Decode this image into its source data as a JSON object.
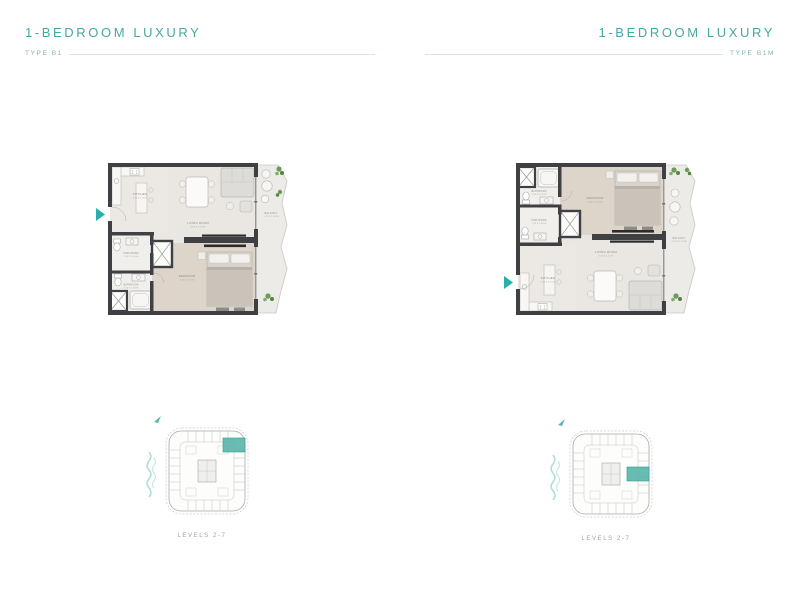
{
  "colors": {
    "accent_teal": "#47a7a3",
    "type_label_teal": "#7cb6b3",
    "entry_arrow_teal": "#27b0ab",
    "unit_highlight_teal": "#54b3a7",
    "wall_charcoal": "#3f4043",
    "water_wave_teal": "#b2dedb"
  },
  "panels": [
    {
      "title": "1-BEDROOM LUXURY",
      "type_label": "TYPE B1",
      "levels_label": "LEVELS 2-7",
      "rooms": {
        "kitchen": {
          "name": "KITCHEN",
          "dims": "3.05 X 1.70 M"
        },
        "living_room": {
          "name": "LIVING ROOM",
          "dims": "3.60 X 4.15 M"
        },
        "bedroom": {
          "name": "BEDROOM",
          "dims": "3.60 X 3.10 M"
        },
        "powder_room": {
          "name": "PWD ROOM",
          "dims": "1.70 X 1.10 M"
        },
        "bathroom": {
          "name": "BATHROOM",
          "dims": "2.50 X 1.60 M"
        },
        "balcony": {
          "name": "BALCONY",
          "dims": "5.75 X 1.10 M"
        }
      }
    },
    {
      "title": "1-BEDROOM LUXURY",
      "type_label": "TYPE B1M",
      "levels_label": "LEVELS 2-7",
      "rooms": {
        "kitchen": {
          "name": "KITCHEN",
          "dims": "3.05 X 1.70 M"
        },
        "living_room": {
          "name": "LIVING ROOM",
          "dims": "3.60 X 4.15 M"
        },
        "bedroom": {
          "name": "BEDROOM",
          "dims": "3.60 X 3.10 M"
        },
        "powder_room": {
          "name": "PWD ROOM",
          "dims": "1.70 X 1.10 M"
        },
        "bathroom": {
          "name": "BATHROOM",
          "dims": "2.50 X 1.60 M"
        },
        "balcony": {
          "name": "BALCONY",
          "dims": "5.75 X 1.10 M"
        }
      }
    }
  ]
}
